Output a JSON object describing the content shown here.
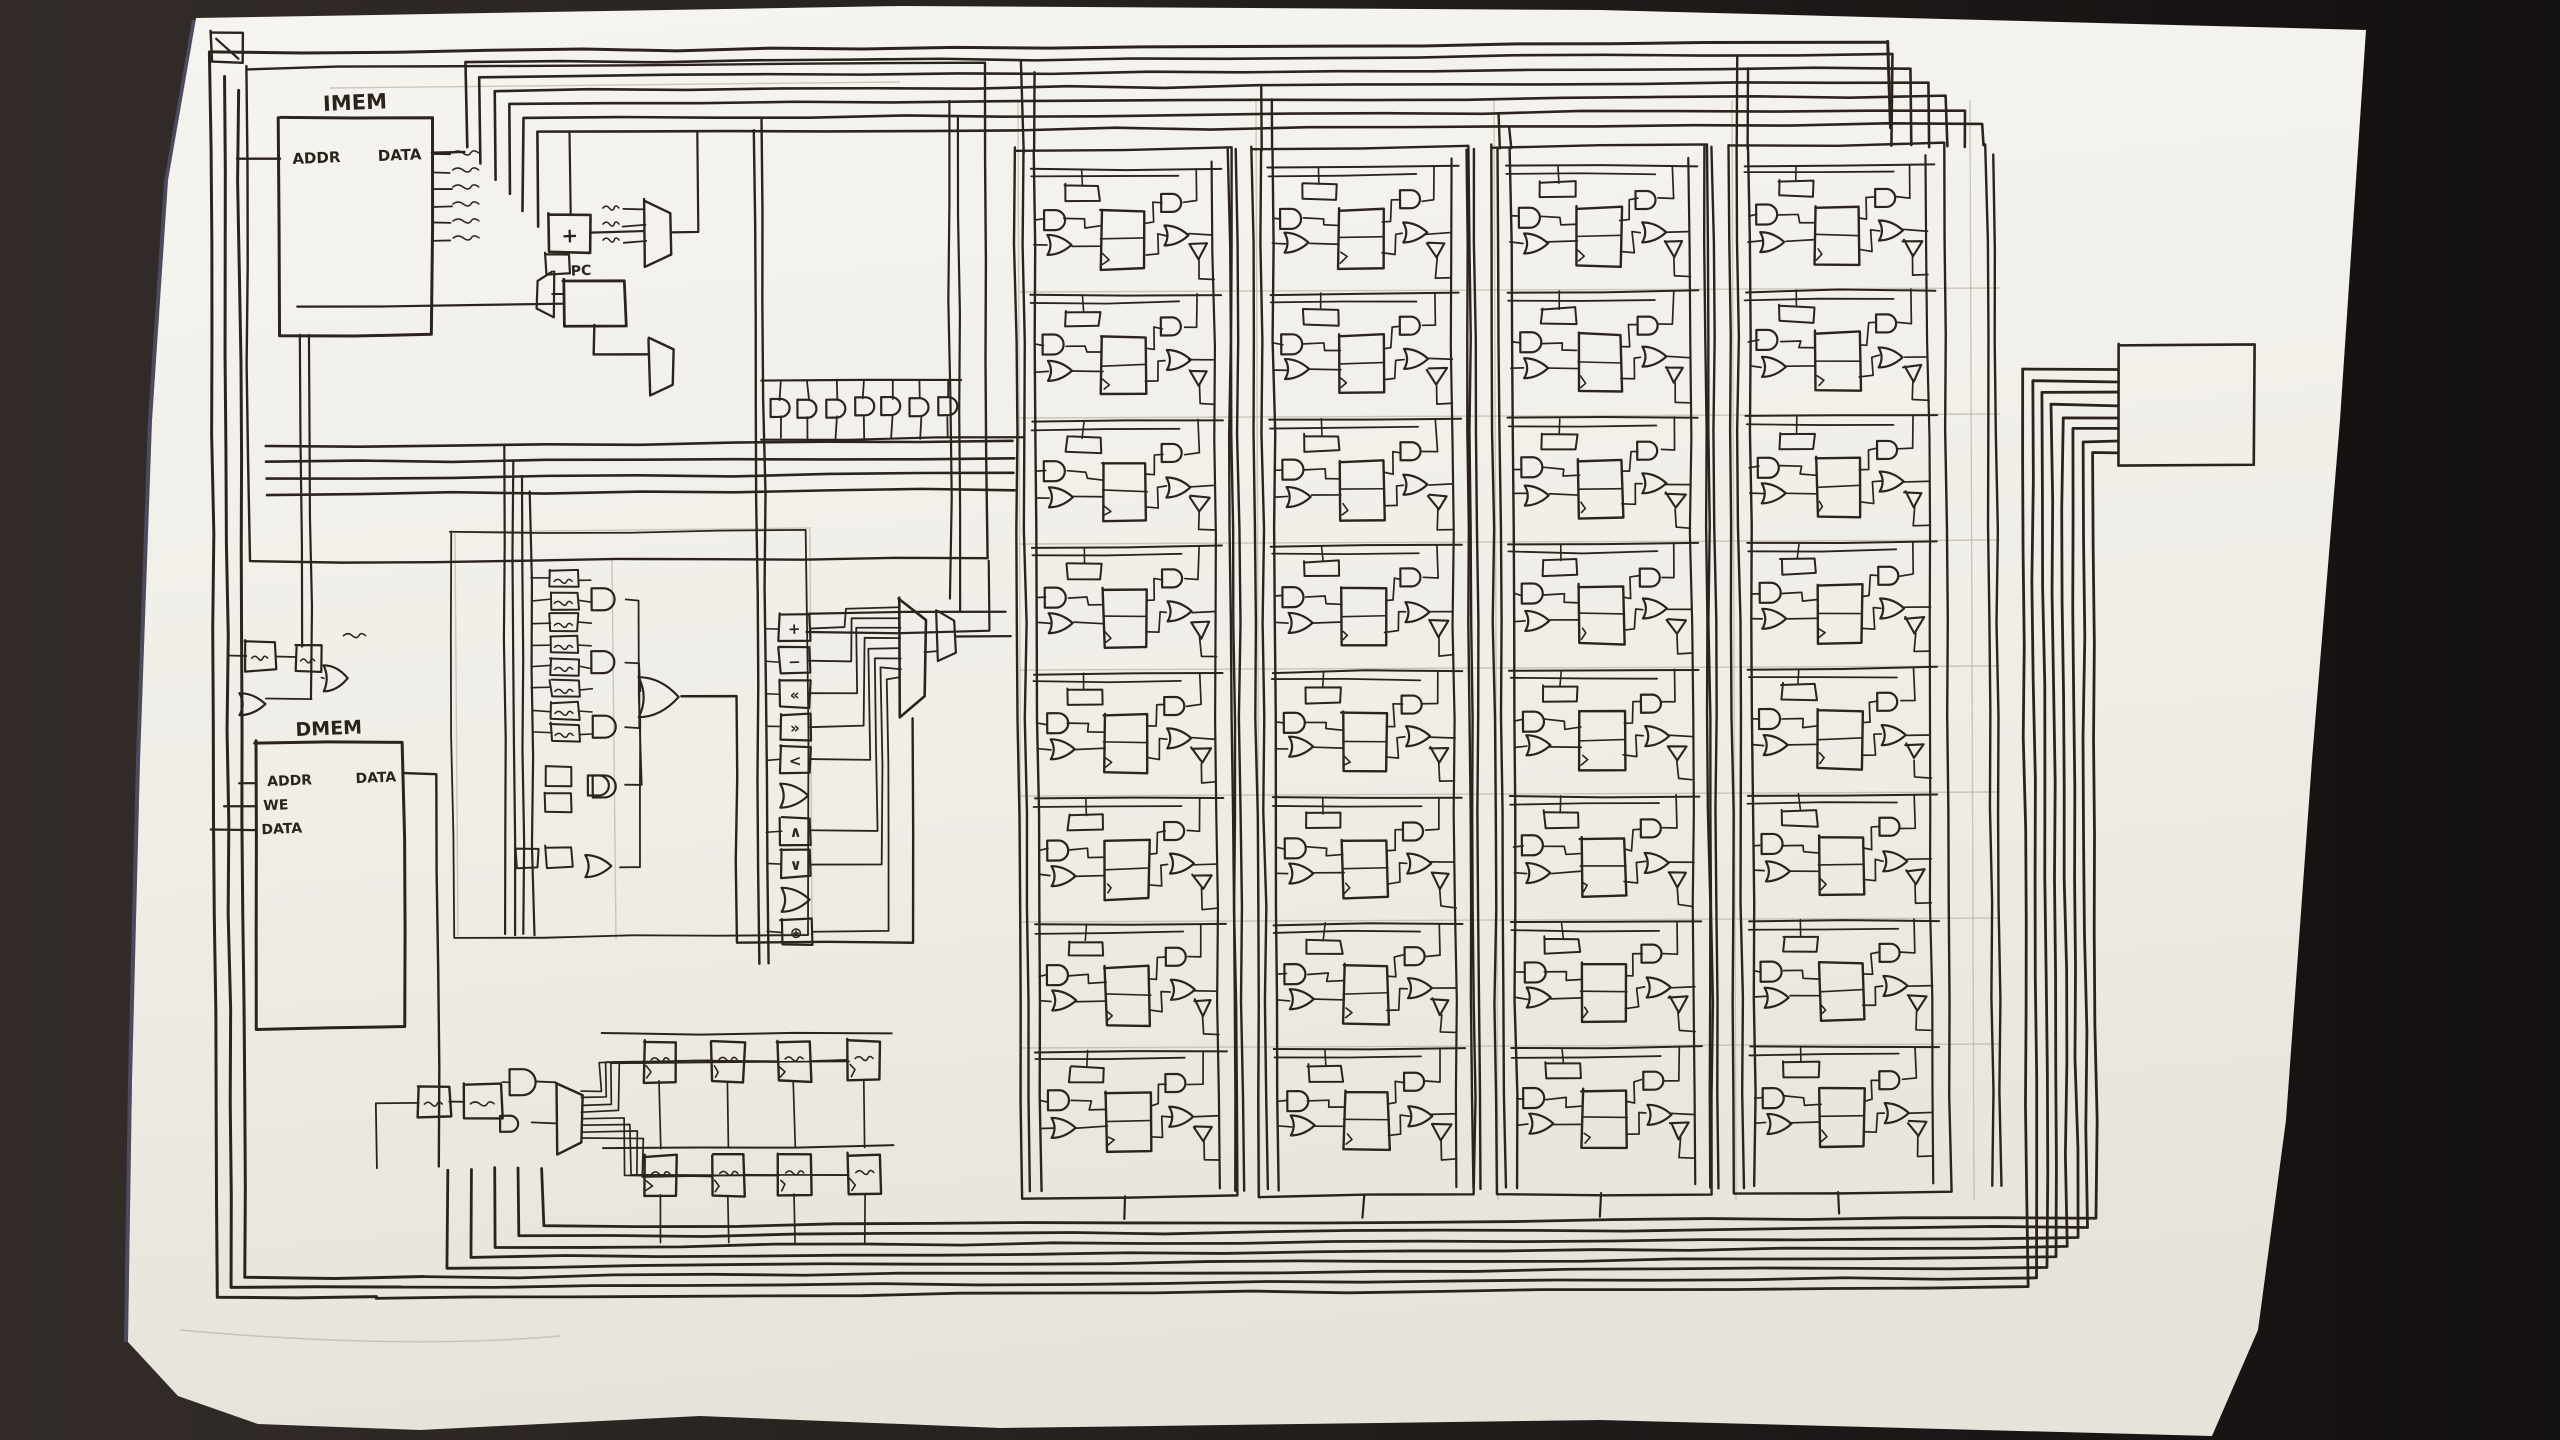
{
  "photo": {
    "background_left": "#2e2826",
    "background_right": "#151110",
    "paper_top": "#f5f3ee",
    "paper_bottom": "#e8e5dd",
    "ink": "#2c231e",
    "pencil": "#b7b0a1",
    "edge_tint": "#8087c6"
  },
  "labels": {
    "imem": {
      "title": "IMEM",
      "addr": "ADDR",
      "data": "DATA"
    },
    "pc": {
      "title": "PC",
      "adder": "+"
    },
    "dmem": {
      "title": "DMEM",
      "addr": "ADDR",
      "we": "WE",
      "data_in": "DATA",
      "data_out": "DATA"
    },
    "alu": {
      "ops": [
        "+",
        "−",
        "«",
        "»",
        "<",
        "∧",
        "∨",
        "⊕"
      ]
    }
  },
  "register_file": {
    "columns": 4,
    "rows": 8
  },
  "bottom_registers": {
    "rows": 2,
    "cols": 4
  }
}
